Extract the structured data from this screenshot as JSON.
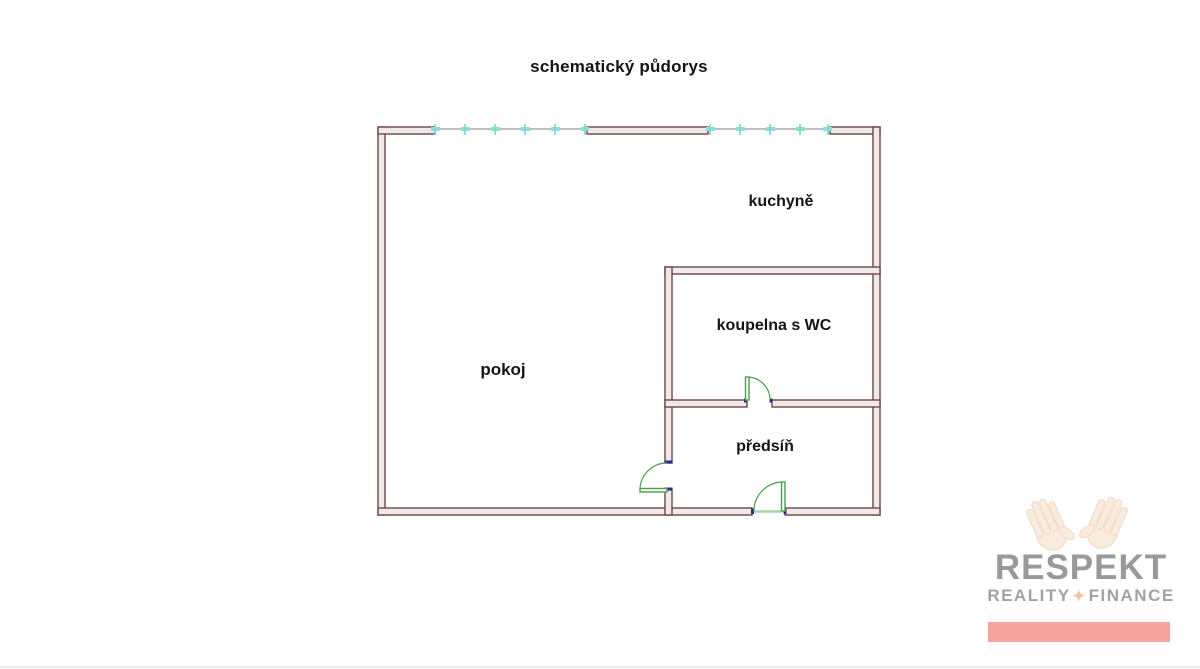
{
  "title": "schematický půdorys",
  "floorplan": {
    "rooms": {
      "kuchyne": "kuchyně",
      "koupelna": "koupelna s WC",
      "pokoj": "pokoj",
      "predsin": "předsíň"
    },
    "colors": {
      "wall_stroke": "#6f4545",
      "wall_fill": "#f0e9e9",
      "window_line": "#ababab",
      "window_tick": "#7fd8d2",
      "door": "#4c9e4c",
      "door_jamb": "#2b2b8f",
      "threshold": "#a5d6a5"
    }
  },
  "logo": {
    "brand": "RESPEKT",
    "tagline_left": "REALITY",
    "separator": "✦",
    "tagline_right": "FINANCE",
    "bar_color": "#f5a29c",
    "text_color": "#999999"
  }
}
